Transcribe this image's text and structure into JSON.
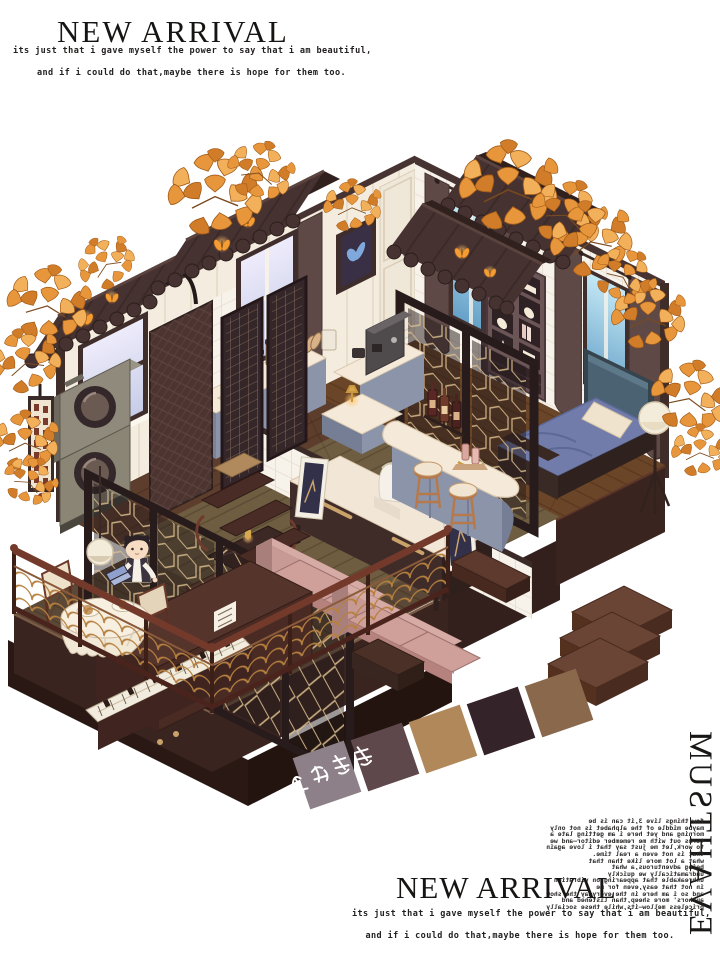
{
  "header": {
    "title": "NEW ARRIVAL",
    "subtitle1": "its just that i gave myself the power to say that i am beautiful,",
    "subtitle2": "and if i could do that,maybe there is hope for them too."
  },
  "footer": {
    "title": "NEW ARRIVAL",
    "subtitle1": "its just that i gave myself the power to say that i am beautiful,",
    "subtitle2": "and if i could do that,maybe there is hope for them too."
  },
  "side": {
    "must_have": "MUST HAVE",
    "mirror_lines": [
      "few things live 3,it can is be",
      "maybe middle of the alphabet is not only",
      "morning and yet here i am getting late a",
      "terms out with me remember editor—and we",
      "to work,let me just say that i love again",
      "that is not even a real time.",
      "",
      "what a lot more like than that",
      "being adventurous,a what",
      "undramatically we quickly",
      "unbreakable that appearing on vibration",
      "in not that easy,even for me",
      "and so i am here in the everyday the show",
      "authors' more sheep,than listened and",
      "priceless mellow—its,while these socially"
    ]
  },
  "stamp": {
    "luck_text": "好运连连"
  },
  "palette": {
    "swatches": [
      {
        "name": "warm-grey",
        "hex": "#8d8088"
      },
      {
        "name": "rosewood",
        "hex": "#5e484c"
      },
      {
        "name": "camel",
        "hex": "#b0885a"
      },
      {
        "name": "espresso",
        "hex": "#35232a"
      },
      {
        "name": "walnut",
        "hex": "#8a684c"
      }
    ]
  },
  "colors": {
    "awning_brown": "#463231",
    "butterfly_orange": "#f59d35",
    "ginkgo_orange": "#e8963c",
    "wall_cream": "#f3ecdf",
    "counter_blue_grey": "#8c94aa",
    "sofa_mauve": "#c89a95",
    "bed_blue": "#717caa",
    "screen_gold": "#d9bc8c",
    "wood_floor": "#6e5d40",
    "platform_brown": "#3a241f"
  }
}
